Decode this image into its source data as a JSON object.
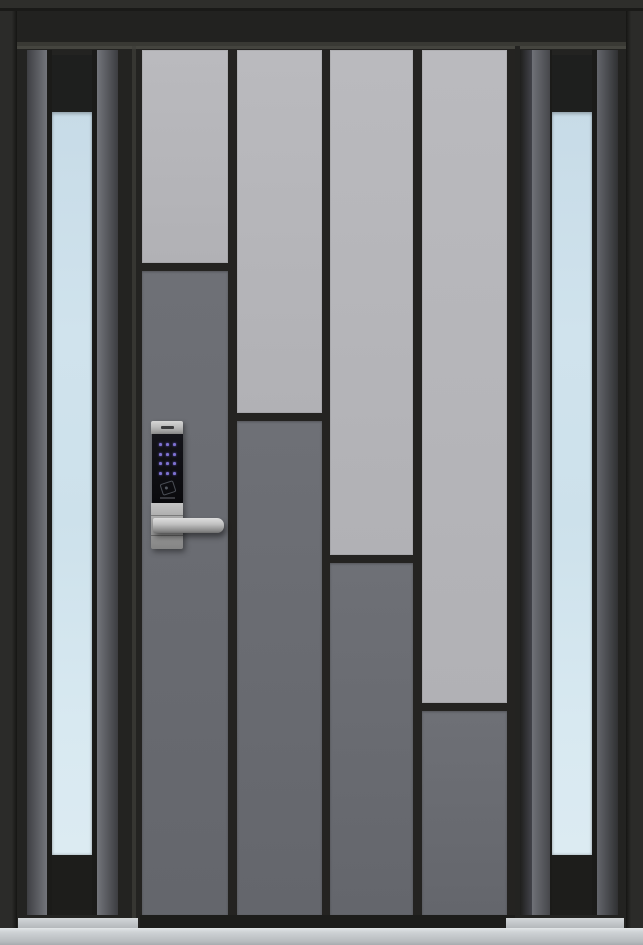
{
  "meta": {
    "type": "product-photo",
    "subject": "Modern single front entry door with two frosted-glass sidelites, staggered two-tone gray vertical panels, and a stainless smart keypad lock with lever handle"
  },
  "palette": {
    "frame_dark": "#232321",
    "frame_highlight": "#45453f",
    "panel_light_gray": "#b5b5b9",
    "panel_dark_gray": "#696b71",
    "sidelite_glass_blue": "#d2e4ee",
    "threshold_silver": "#c3c7ca",
    "lock_stainless": "#b9b9b9",
    "lock_keypad_black": "#0e0e11",
    "keypad_dot_purple": "#8a7ce6"
  },
  "door": {
    "column_count": 4,
    "pattern": "each column is light gray above a staggered split line and dark gray below; split steps down left to right",
    "panel_top_rel": 4,
    "panel_bottom_rel": 869,
    "divider_h": 8,
    "columns": [
      {
        "name": "column-1",
        "x": 2,
        "width": 86,
        "split_y_abs": 263,
        "split_rel": 217
      },
      {
        "name": "column-2",
        "x": 97,
        "width": 85,
        "split_y_abs": 413,
        "split_rel": 367
      },
      {
        "name": "column-3",
        "x": 190,
        "width": 83,
        "split_y_abs": 555,
        "split_rel": 509
      },
      {
        "name": "column-4",
        "x": 282,
        "width": 85,
        "split_y_abs": 703,
        "split_rel": 657
      }
    ]
  },
  "sidelites": {
    "count": 2,
    "glass_finish": "frosted light blue",
    "glass_top_y": 112,
    "glass_bottom_y": 855,
    "black_header_above_glass": true
  },
  "lock": {
    "keypad_rows": 4,
    "keypad_cols": 3,
    "has_rfid_reader": true,
    "has_lever_handle": true,
    "brand_label_visible": true,
    "brand_label_legible": false
  }
}
